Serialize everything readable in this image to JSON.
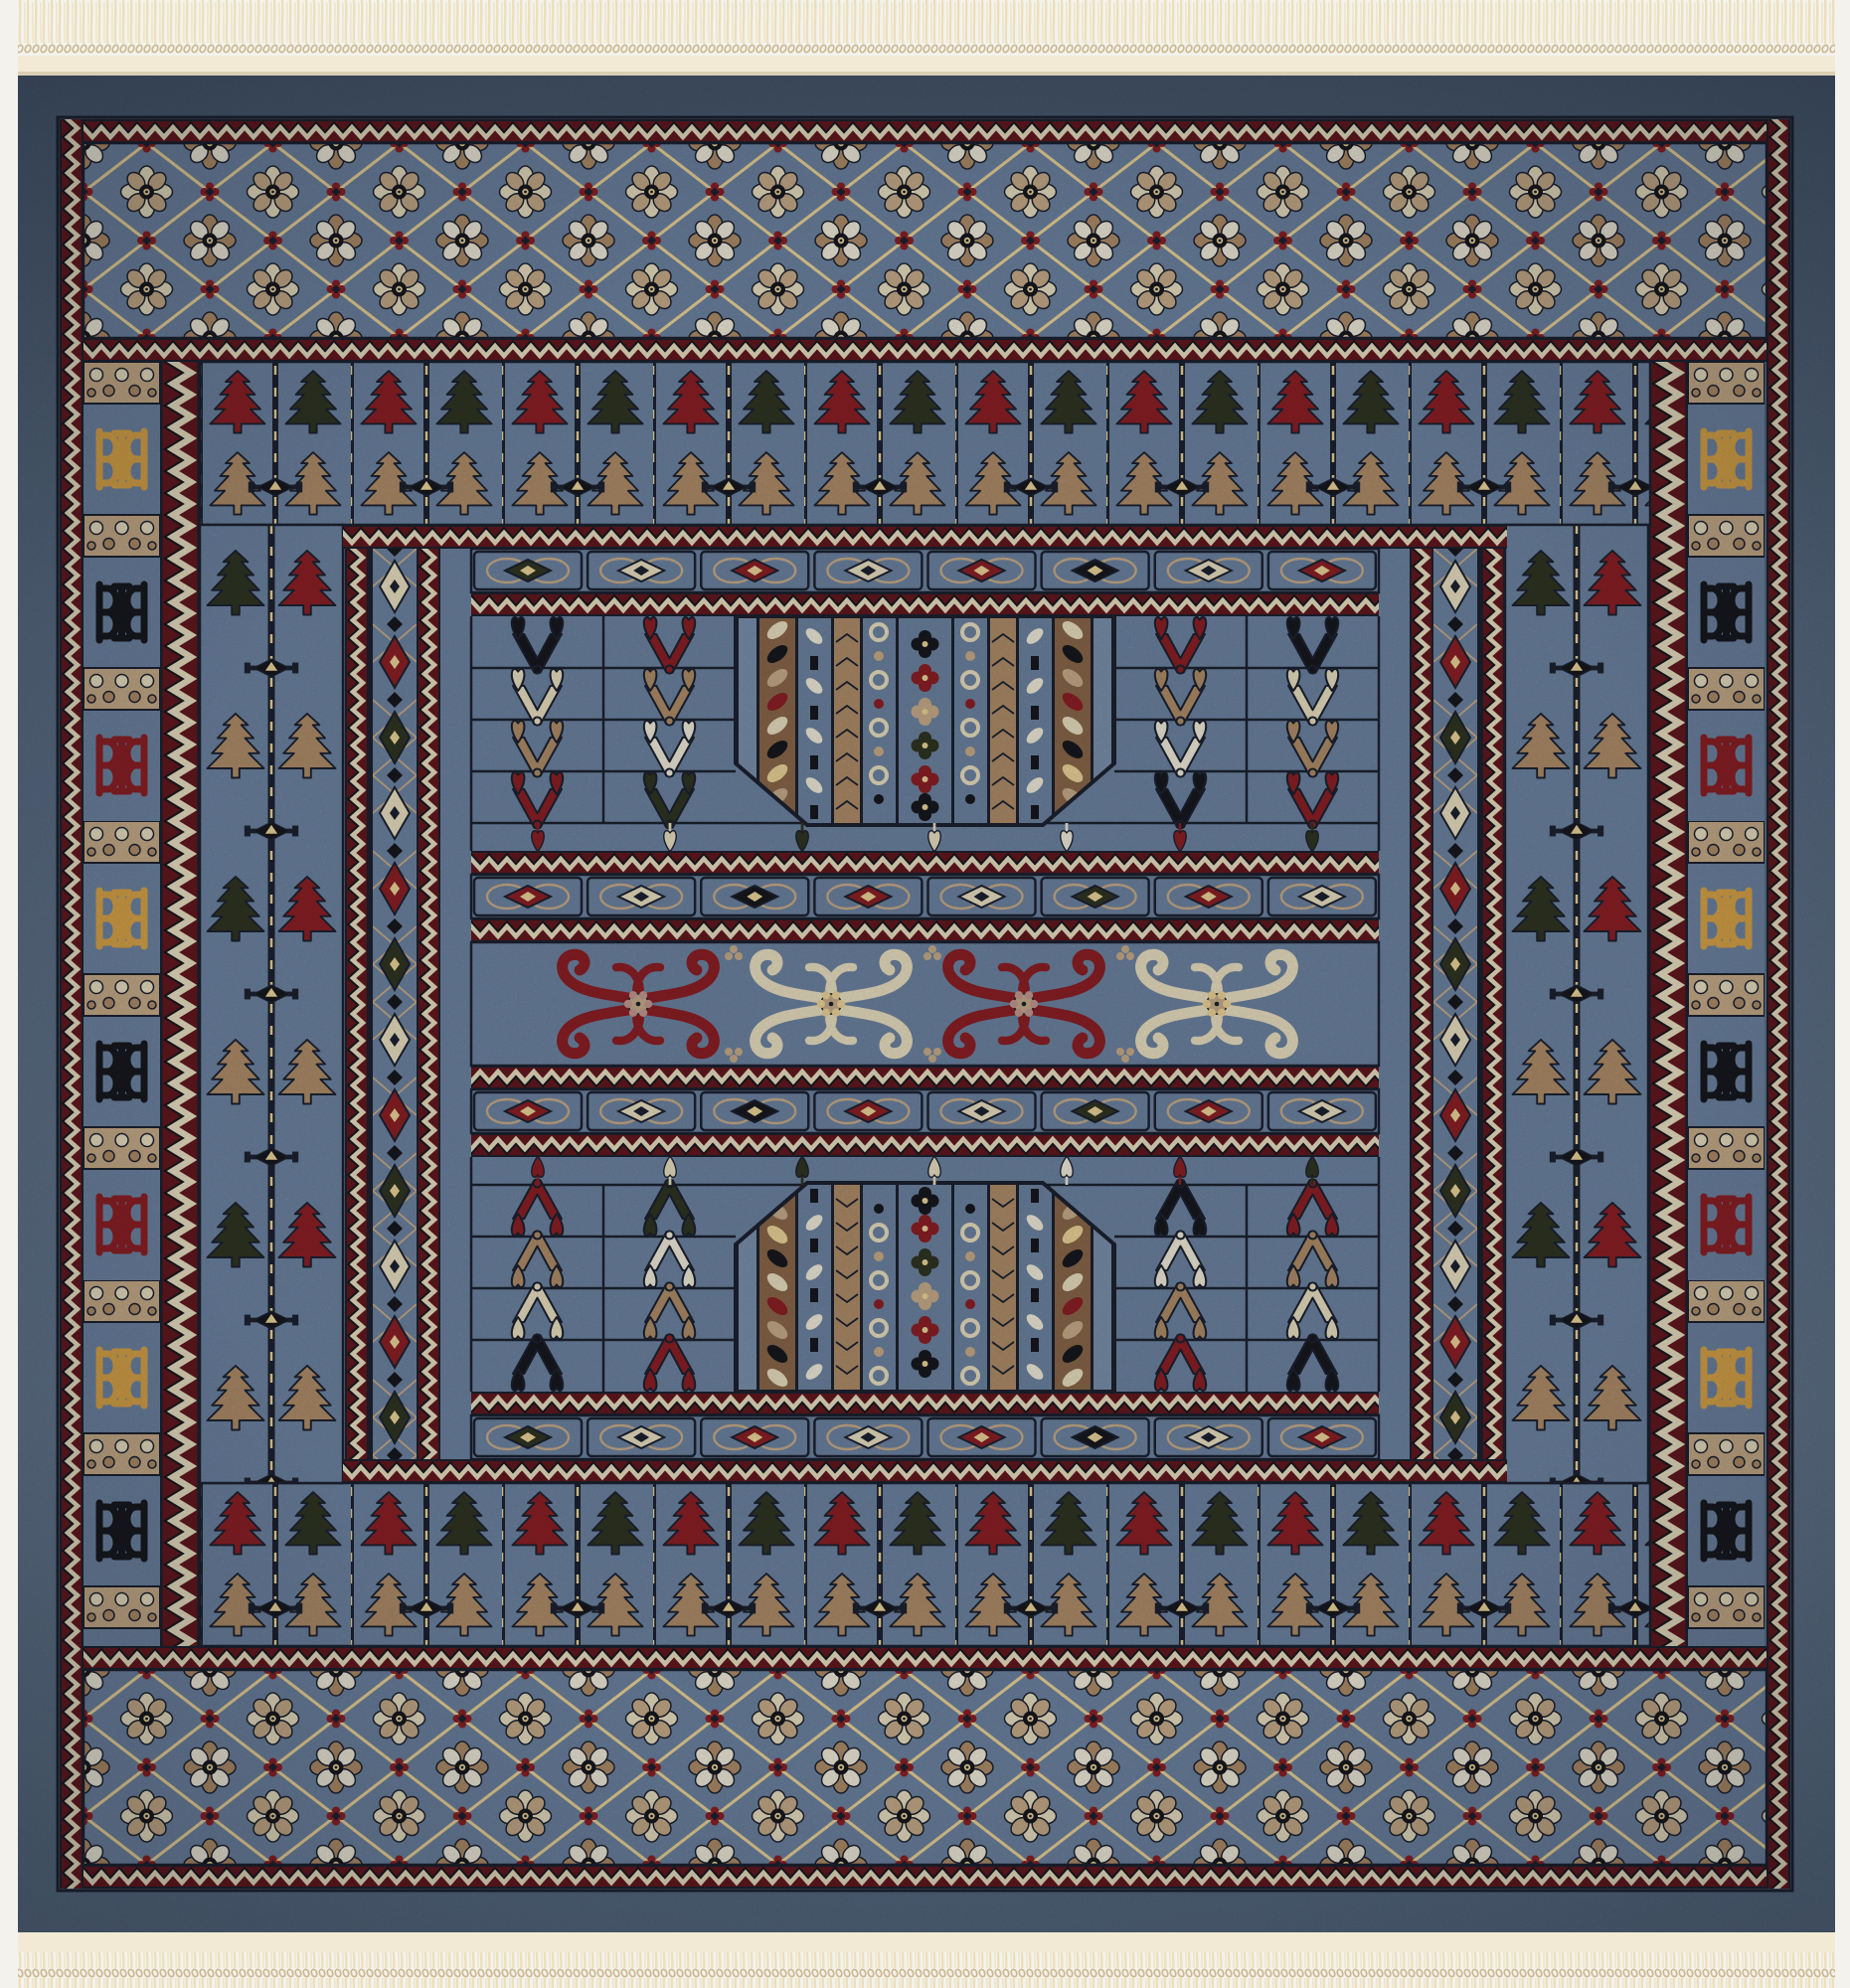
{
  "scene": {
    "title": "Photograph of a square blue Bokhara-style oriental rug with cream fringe at top and bottom",
    "type": "photograph",
    "object": "oriental-rug"
  },
  "palette": {
    "backing": "#f4f2ed",
    "fringe": "#ecdfbc",
    "fringe_dark": "#cdb88f",
    "kilim": "#f2ead4",
    "blue_border": "#56687f",
    "blue_border_dark": "#45566c",
    "blue_field": "#6e84a2",
    "blue_field_light": "#7b91ad",
    "navy": "#1c2230",
    "black": "#17181e",
    "dark_green": "#2f3523",
    "maroon": "#63181f",
    "red": "#8c2026",
    "gold": "#d9a449",
    "pale_gold": "#eed69a",
    "cream": "#eae0c2",
    "white": "#f1ecdc",
    "tan": "#b08e6a",
    "tan_light": "#c8ad8a",
    "tan_dark": "#8a684a",
    "pink": "#c59a92"
  },
  "motifs": {
    "flower_border": {
      "lattice": "gold diagonal lattice",
      "petals": [
        "cream",
        "tan_light"
      ],
      "knots": "red"
    },
    "tree_colors": [
      "tan",
      "red",
      "dark_green"
    ],
    "bhb_cycle": [
      "gold",
      "black",
      "red"
    ],
    "diamond_cycle": [
      "cream",
      "red",
      "dark_green"
    ],
    "scroll_colors": [
      "red",
      "cream",
      "red",
      "cream"
    ],
    "cartouche_rows": [
      [
        "dark_green",
        "cream",
        "red",
        "cream",
        "red",
        "black",
        "cream",
        "red"
      ],
      [
        "red",
        "cream",
        "black",
        "red",
        "cream",
        "dark_green",
        "red",
        "cream"
      ]
    ],
    "heart_rows": [
      [
        "black",
        "red",
        "red",
        "black"
      ],
      [
        "cream",
        "tan",
        "tan",
        "cream"
      ],
      [
        "tan",
        "white",
        "white",
        "tan"
      ],
      [
        "red",
        "dark_green",
        "black",
        "red"
      ]
    ],
    "hanging_hearts": [
      "red",
      "cream",
      "dark_green",
      "cream",
      "white",
      "red",
      "dark_green"
    ]
  }
}
